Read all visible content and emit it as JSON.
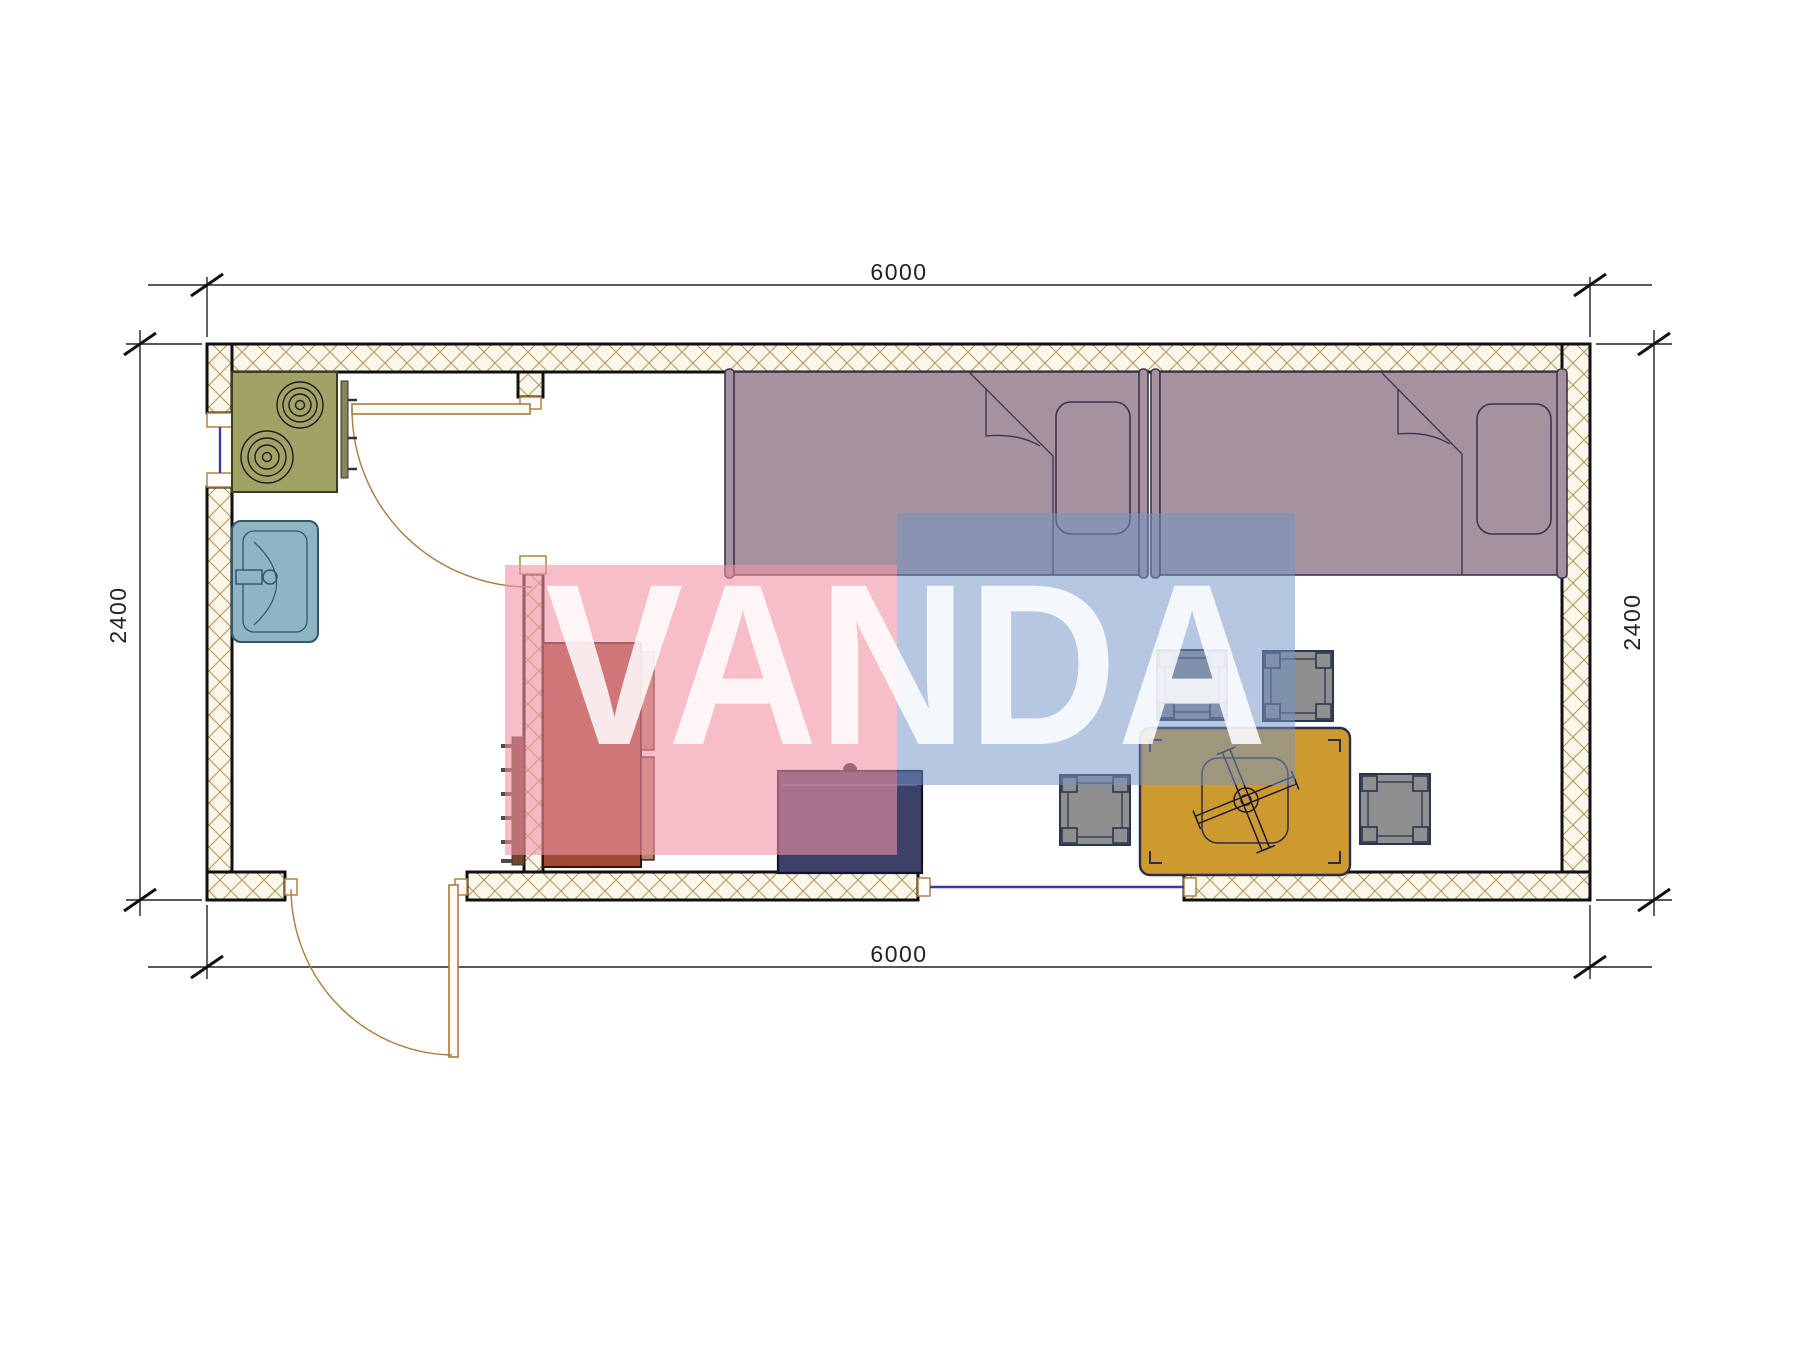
{
  "dimensions": {
    "top": "6000",
    "bottom": "6000",
    "left": "2400",
    "right": "2400"
  },
  "watermark": {
    "text": "VANDA",
    "pink_box": "rgba(241,147,165,0.60)",
    "blue_box": "rgba(115,147,197,0.52)",
    "letters": "rgba(255,255,255,0.85)"
  },
  "colors": {
    "wall_fill": "#faf6ea",
    "wall_hatch": "#b49a5c",
    "wall_edge": "#101010",
    "bed": "#a6929e",
    "bed_line": "#39344f",
    "wardrobe": "#9d4936",
    "wardrobe_panel": "#b5826a",
    "ladder_strip": "#6f4430",
    "nightstand": "#3d4168",
    "table": "#cc9a2e",
    "table_line": "#2b2b4a",
    "stool": "#8f8f8f",
    "stool_line": "#2a3550",
    "stove": "#a0a266",
    "sink": "#8fb4c4",
    "sink_line": "#2f5868",
    "door": "#a97b3e",
    "window": "#3a3ab0",
    "dim_line": "#222222"
  },
  "legend": {
    "plan": "container-house floor plan 6000 x 2400",
    "rooms": [
      "kitchen-bath room",
      "living-sleeping room"
    ],
    "furniture": [
      "stove",
      "sink",
      "single-bed-1",
      "single-bed-2",
      "wardrobe",
      "ladder",
      "nightstand",
      "dining-table",
      "ceiling-fan",
      "stool-1",
      "stool-2",
      "stool-3",
      "stool-4"
    ],
    "openings": [
      "interior-door",
      "entry-door",
      "left-window",
      "bottom-window"
    ]
  }
}
